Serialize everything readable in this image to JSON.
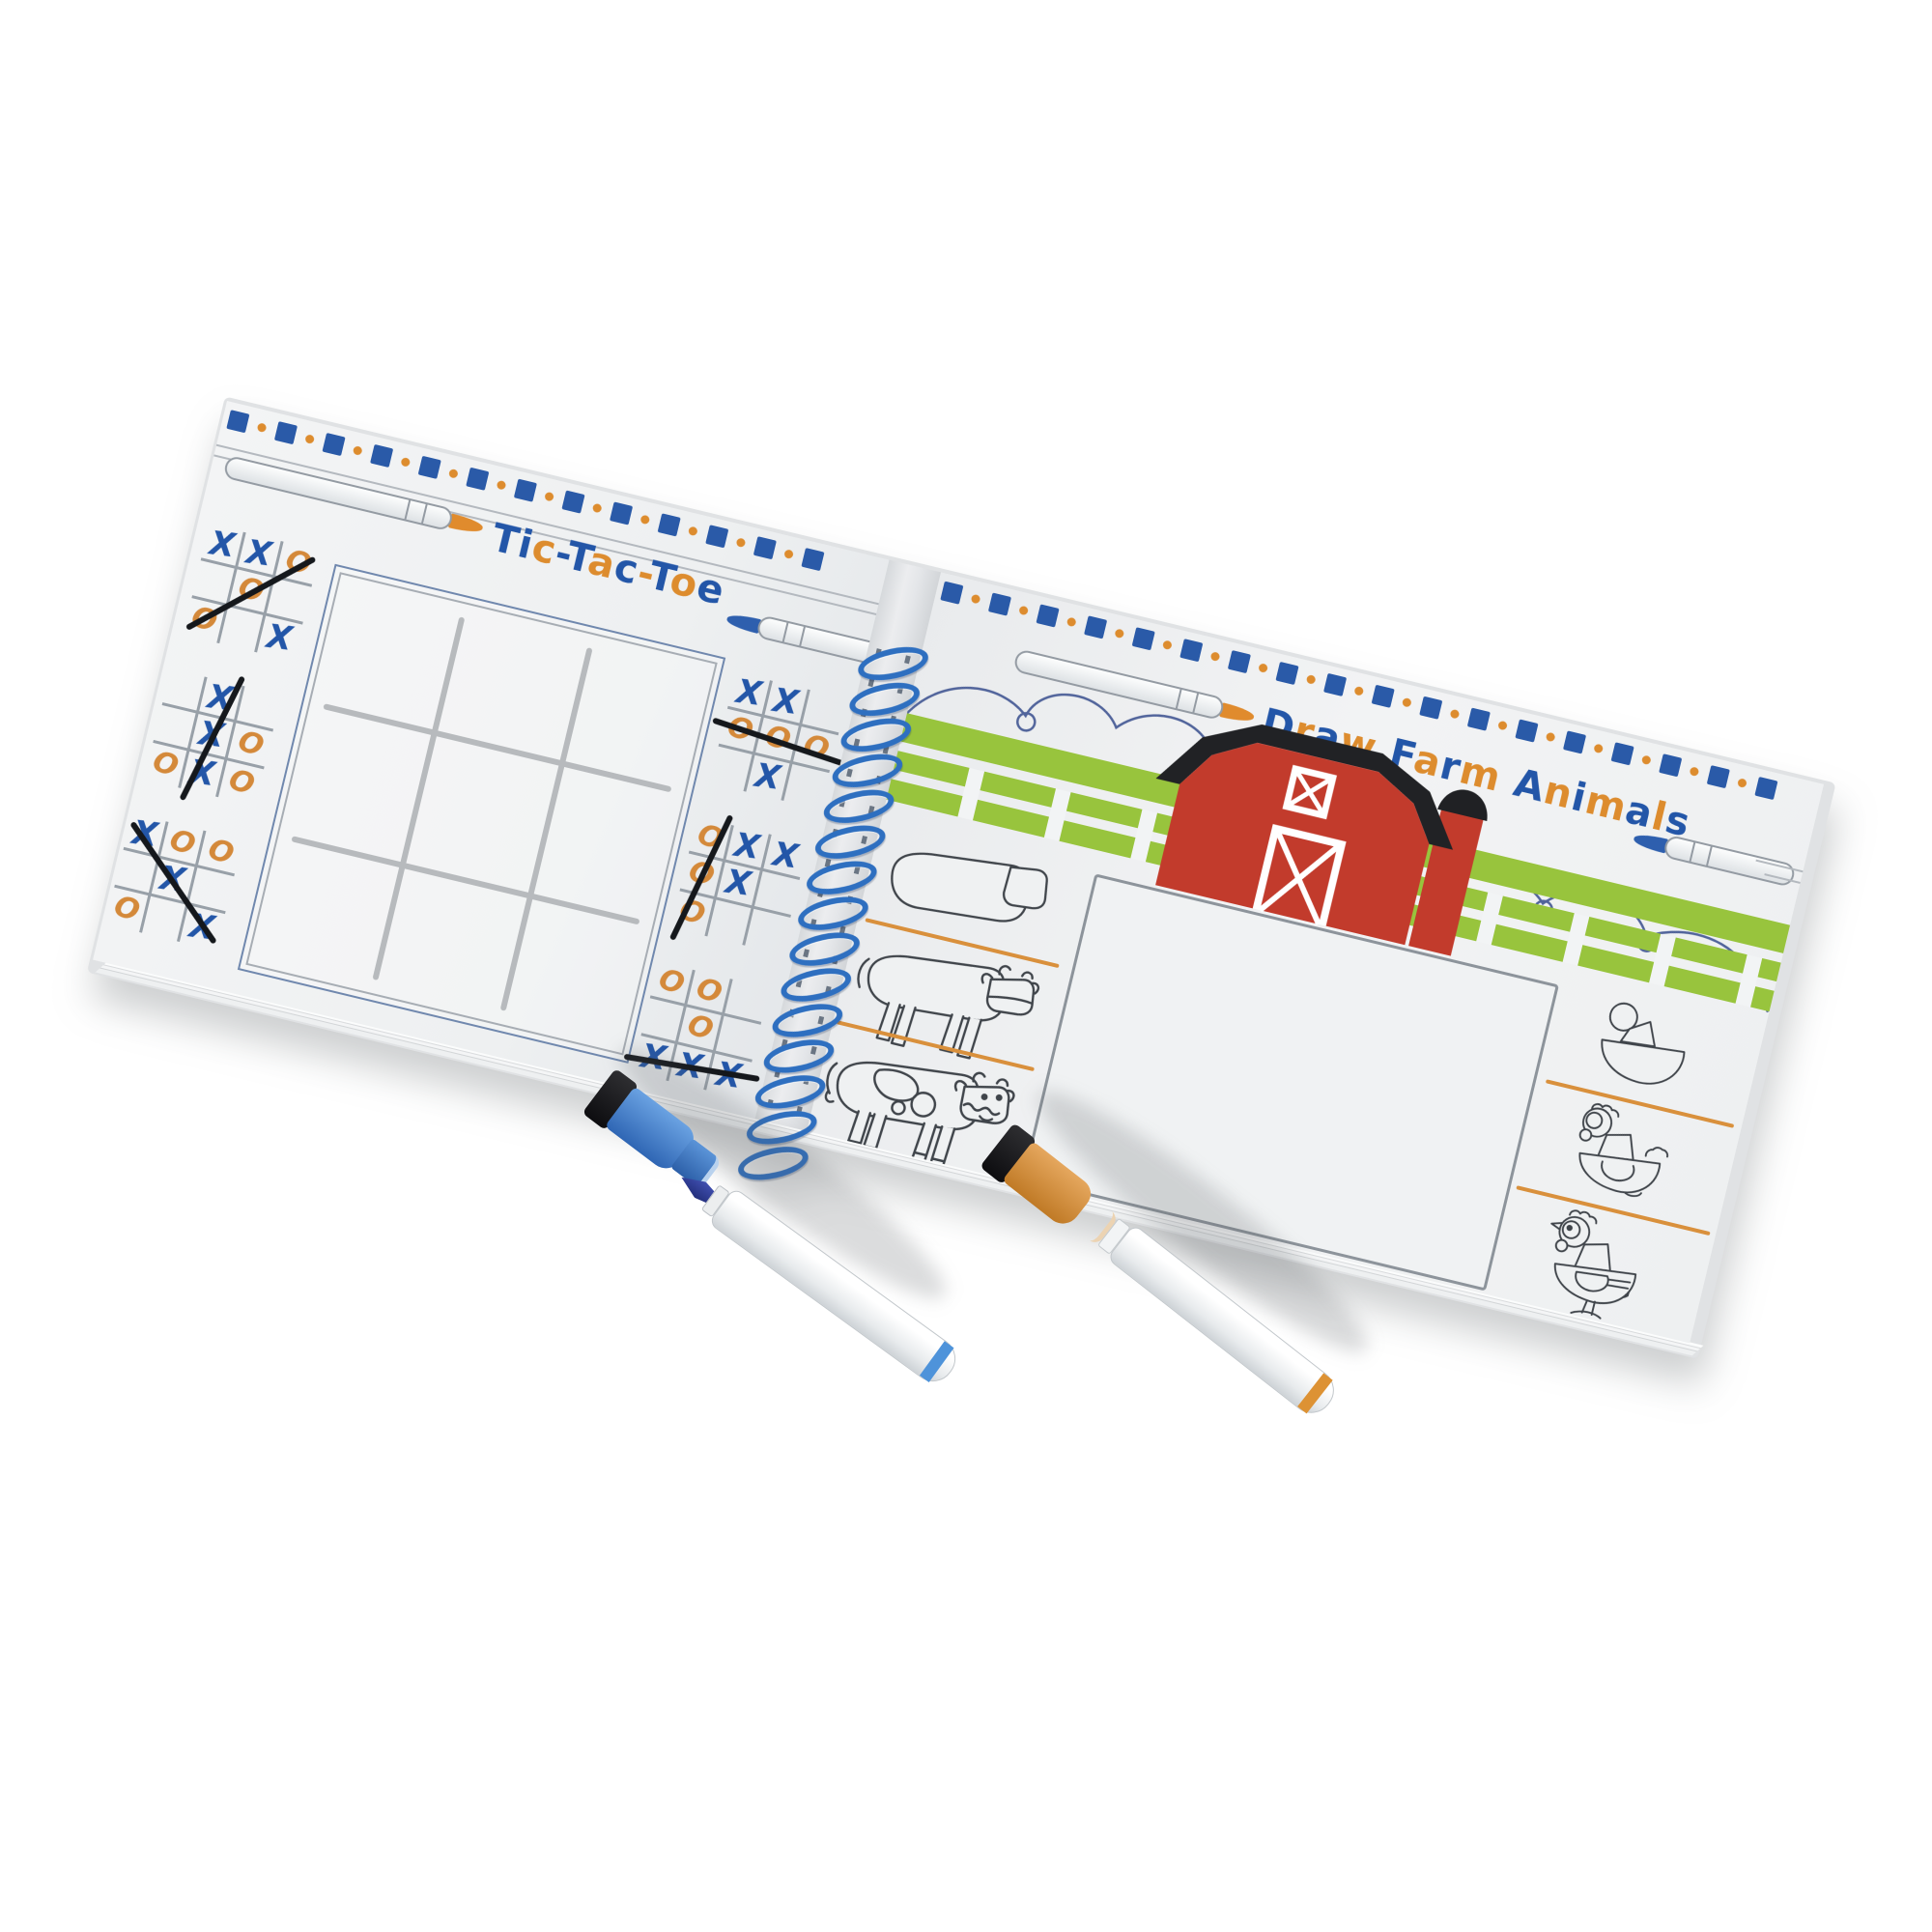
{
  "scene": {
    "type": "product-photo",
    "background_color": "#ffffff",
    "subject": "Open spiral-bound dry-erase activity pad with two dry-erase markers"
  },
  "book": {
    "spiral": {
      "coils": 15,
      "color": "#2e6fc0"
    },
    "left_page": {
      "title": {
        "text": "Tic-Tac-Toe",
        "pattern": "bbobbobobob"
      },
      "border_units": 13,
      "main_grid": {
        "rows": 3,
        "cols": 3,
        "state": "empty"
      },
      "mini_games": [
        {
          "cells": [
            [
              "X",
              "X",
              "O"
            ],
            [
              "",
              "O",
              ""
            ],
            [
              "O",
              "",
              "X"
            ]
          ],
          "strike": {
            "type": "anti",
            "tilt": 0
          },
          "winner": "O"
        },
        {
          "cells": [
            [
              "",
              "X",
              ""
            ],
            [
              "",
              "X",
              "O"
            ],
            [
              "O",
              "X",
              "O"
            ]
          ],
          "strike": {
            "type": "col2",
            "tilt": 13
          },
          "winner": "X"
        },
        {
          "cells": [
            [
              "X",
              "O",
              "O"
            ],
            [
              "",
              "X",
              ""
            ],
            [
              "O",
              "",
              "X"
            ]
          ],
          "strike": {
            "type": "diag",
            "tilt": 0
          },
          "winner": "X"
        },
        {
          "cells": [
            [
              "X",
              "X",
              ""
            ],
            [
              "O",
              "O",
              "O"
            ],
            [
              "",
              "X",
              ""
            ]
          ],
          "strike": {
            "type": "row2",
            "tilt": 5
          },
          "winner": "O"
        },
        {
          "cells": [
            [
              "O",
              "X",
              "X"
            ],
            [
              "O",
              "X",
              ""
            ],
            [
              "O",
              "",
              ""
            ]
          ],
          "strike": {
            "type": "col1",
            "tilt": 12
          },
          "winner": "O"
        },
        {
          "cells": [
            [
              "O",
              "O",
              ""
            ],
            [
              "",
              "O",
              ""
            ],
            [
              "X",
              "X",
              "X"
            ]
          ],
          "strike": {
            "type": "row3",
            "tilt": -4
          },
          "winner": "X"
        }
      ]
    },
    "right_page": {
      "title": {
        "text": "Draw Farm Animals",
        "pattern": "bobo-bobo-bobobob"
      },
      "border_units": 18,
      "illustrations": [
        "clouds",
        "green fence",
        "red barn",
        "red silo"
      ],
      "tutorials": [
        {
          "subject": "cow",
          "steps": 3
        },
        {
          "subject": "chicken",
          "steps": 3
        }
      ],
      "drawing_area": {
        "state": "blank"
      }
    }
  },
  "markers": [
    {
      "id": "blue",
      "body": "white",
      "accent": "#3f7ec9",
      "state": "uncapped, cap lying beside exposed tip",
      "parts": [
        "black eraser pad",
        "blue cap",
        "dark blue felt tip",
        "white barrel",
        "blue end ring"
      ]
    },
    {
      "id": "orange",
      "body": "white",
      "accent": "#d6913c",
      "state": "capped",
      "parts": [
        "black eraser pad",
        "orange cap",
        "white barrel",
        "orange end ring"
      ]
    }
  ],
  "palette": {
    "blue": "#2a5aa8",
    "orange": "#dd8c2e",
    "green": "#98c43d",
    "red": "#c23b2c",
    "black": "#1c1e21",
    "page": "#eff1f2",
    "line_gray": "#9aa1a9",
    "spiral_blue": "#2e6fc0"
  }
}
